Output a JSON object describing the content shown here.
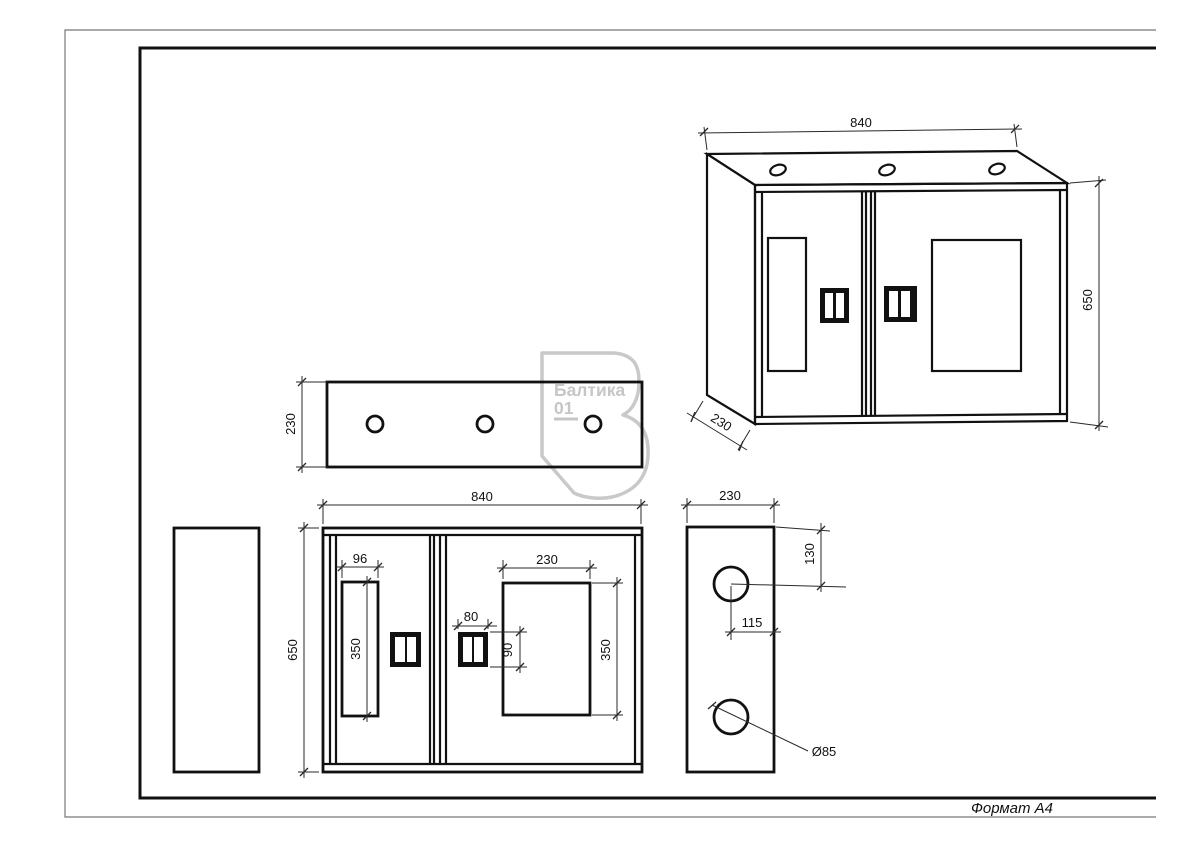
{
  "sheet": {
    "format_label": "Формат А4"
  },
  "watermark": {
    "brand": "Балтика",
    "number": "01",
    "color": "#c7c7c7"
  },
  "colors": {
    "ink": "#111111",
    "dim_line": "#2a2a2a",
    "page_border": "#777777"
  },
  "isometric_view": {
    "width": "840",
    "height": "650",
    "depth": "230"
  },
  "top_view": {
    "depth": "230"
  },
  "front_view": {
    "width": "840",
    "height": "650",
    "left_window_width": "96",
    "left_window_height": "350",
    "right_window_width": "230",
    "right_window_height": "350",
    "handle_width": "80",
    "handle_height": "90"
  },
  "side_view": {
    "width": "230",
    "top_hole_offset": "130",
    "hole_center_offset": "115",
    "hole_diameter": "Ø85"
  }
}
